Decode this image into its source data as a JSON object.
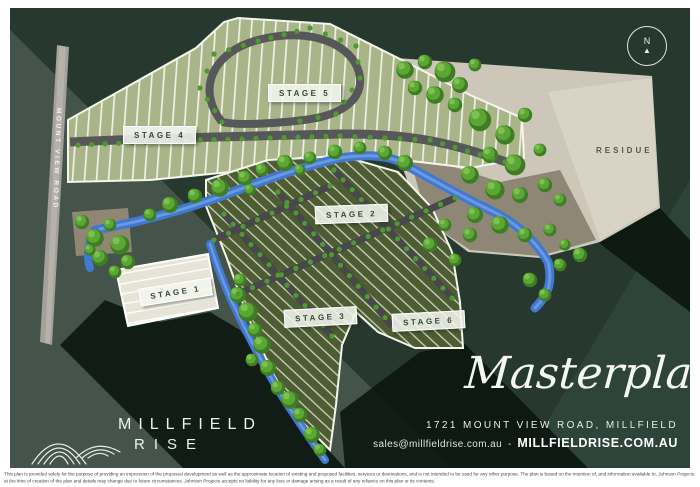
{
  "poster": {
    "north_label": "N",
    "north_arrow_glyph": "▲",
    "road_label": "MOUNT VIEW ROAD",
    "residue_label": "RESIDUE",
    "stages": [
      {
        "label": "STAGE 1"
      },
      {
        "label": "STAGE 2"
      },
      {
        "label": "STAGE 3"
      },
      {
        "label": "STAGE 4"
      },
      {
        "label": "STAGE 5"
      },
      {
        "label": "STAGE 6"
      }
    ],
    "logo": {
      "line1": "MILLFIELD",
      "line2": "RISE"
    },
    "title_script": "Masterplan",
    "address": "1721 MOUNT VIEW ROAD, MILLFIELD",
    "email": "sales@millfieldrise.com.au",
    "separator": "-",
    "website": "MILLFIELDRISE.COM.AU",
    "colors": {
      "background_dark_green": "#27392f",
      "background_light_facet": "#45544a",
      "shadow_black": "#0b150f",
      "lots_sage": "#a9b489",
      "lots_olive": "#4d5c33",
      "road_grey": "#57575a",
      "creek_blue": "#4079cf",
      "residue_beige": "#d6d0c3",
      "tree_green": "#5ca636",
      "label_text_green": "#33493c"
    },
    "disclaimer_line1": "This plan is provided solely for the purpose of providing an impression of the proposed development as well as the approximate location of existing and proposed facilities, services or destinations, and is not intended to be used for any other purpose. The plan is based on the intention of, and information available to, Johnson Projects at the time of creation of the plan",
    "disclaimer_line2": "and details may change due to future circumstances. Johnson Projects accepts no liability for any loss or damage arising as a result of any reliance on this plan or its contents."
  }
}
